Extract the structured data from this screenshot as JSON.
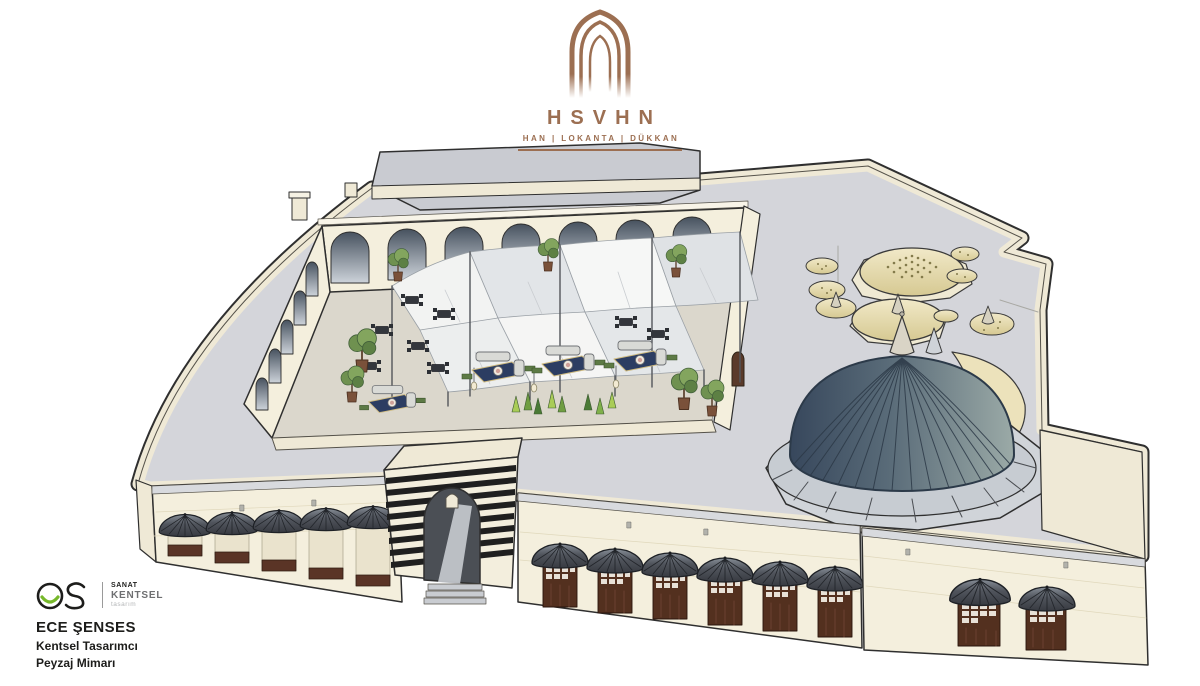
{
  "brand": {
    "logo_icon": "pointed-arch-icon",
    "name": "HSVHN",
    "tagline": "HAN | LOKANTA | DÜKKAN",
    "accent_color": "#9c6f52"
  },
  "credits": {
    "monogram_icon": "es-monogram-icon",
    "studio_line1": "SANAT",
    "studio_line2": "KENTSEL",
    "studio_line3": "tasarım",
    "designer_name": "ECE ŞENSES",
    "designer_title1": "Kentsel Tasarımcı",
    "designer_title2": "Peyzaj Mimarı",
    "accent_green": "#76b82a"
  },
  "illustration": {
    "elements": [
      "roof-plaza",
      "back-building",
      "arcaded-courtyard",
      "shade-sails",
      "dining-tables",
      "lounge-seating",
      "potted-trees",
      "cypress-trees",
      "hanging-lamps",
      "main-ribbed-dome",
      "hamam-domes",
      "entrance-portal",
      "shopfront-awnings",
      "striped-gate"
    ],
    "colors": {
      "stone_cream": "#f4efdd",
      "plaza_gray": "#d4d5da",
      "dome_blue_dark": "#3e4d60",
      "dome_blue_light": "#97a8a6",
      "hamam_cream": "#e9e0b4",
      "awning_gray": "#4b4f57",
      "door_brown": "#5a3426",
      "sail_white": "#f7f7f5",
      "stripe_black": "#1f1f1f",
      "rug_navy": "#2c3d62",
      "outline": "#2f2f2f"
    }
  }
}
